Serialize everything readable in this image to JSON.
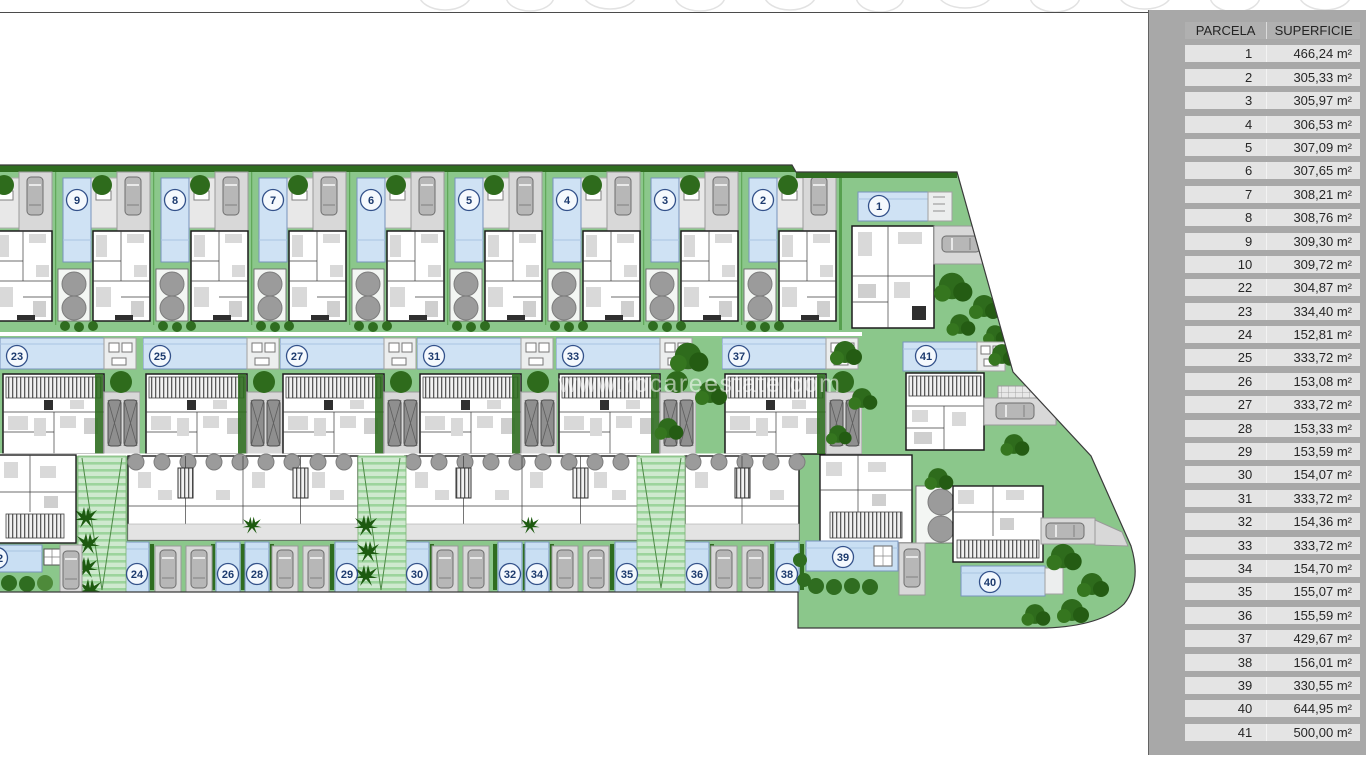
{
  "watermark": "www.rocareestate.com",
  "colors": {
    "panel": "#a8a8a8",
    "table_row": "#e4e4e4",
    "table_header": "#b0b0b0",
    "lawn": "#8bc78b",
    "pool": "#cfe2f4",
    "tree": "#2e6b1c",
    "driveway": "#d8d8d8",
    "badge_ring": "#33518a"
  },
  "table": {
    "headers": [
      "PARCELA",
      "SUPERFICIE"
    ],
    "rows": [
      [
        "1",
        "466,24 m²"
      ],
      [
        "2",
        "305,33 m²"
      ],
      [
        "3",
        "305,97 m²"
      ],
      [
        "4",
        "306,53 m²"
      ],
      [
        "5",
        "307,09 m²"
      ],
      [
        "6",
        "307,65 m²"
      ],
      [
        "7",
        "308,21 m²"
      ],
      [
        "8",
        "308,76 m²"
      ],
      [
        "9",
        "309,30 m²"
      ],
      [
        "10",
        "309,72 m²"
      ],
      [
        "22",
        "304,87 m²"
      ],
      [
        "23",
        "334,40 m²"
      ],
      [
        "24",
        "152,81 m²"
      ],
      [
        "25",
        "333,72 m²"
      ],
      [
        "26",
        "153,08 m²"
      ],
      [
        "27",
        "333,72 m²"
      ],
      [
        "28",
        "153,33 m²"
      ],
      [
        "29",
        "153,59 m²"
      ],
      [
        "30",
        "154,07 m²"
      ],
      [
        "31",
        "333,72 m²"
      ],
      [
        "32",
        "154,36 m²"
      ],
      [
        "33",
        "333,72 m²"
      ],
      [
        "34",
        "154,70 m²"
      ],
      [
        "35",
        "155,07 m²"
      ],
      [
        "36",
        "155,59 m²"
      ],
      [
        "37",
        "429,67 m²"
      ],
      [
        "38",
        "156,01 m²"
      ],
      [
        "39",
        "330,55 m²"
      ],
      [
        "40",
        "644,95 m²"
      ],
      [
        "41",
        "500,00 m²"
      ]
    ]
  },
  "plan": {
    "badges": [
      {
        "n": "9",
        "x": 77,
        "y": 200
      },
      {
        "n": "8",
        "x": 175,
        "y": 200
      },
      {
        "n": "7",
        "x": 273,
        "y": 200
      },
      {
        "n": "6",
        "x": 371,
        "y": 200
      },
      {
        "n": "5",
        "x": 469,
        "y": 200
      },
      {
        "n": "4",
        "x": 567,
        "y": 200
      },
      {
        "n": "3",
        "x": 665,
        "y": 200
      },
      {
        "n": "2",
        "x": 763,
        "y": 200
      },
      {
        "n": "1",
        "x": 879,
        "y": 206
      },
      {
        "n": "23",
        "x": 17,
        "y": 356
      },
      {
        "n": "25",
        "x": 160,
        "y": 356
      },
      {
        "n": "27",
        "x": 297,
        "y": 356
      },
      {
        "n": "31",
        "x": 434,
        "y": 356
      },
      {
        "n": "33",
        "x": 573,
        "y": 356
      },
      {
        "n": "37",
        "x": 739,
        "y": 356
      },
      {
        "n": "41",
        "x": 926,
        "y": 356
      },
      {
        "n": "22",
        "x": -3,
        "y": 558
      },
      {
        "n": "24",
        "x": 137,
        "y": 574
      },
      {
        "n": "26",
        "x": 228,
        "y": 574
      },
      {
        "n": "28",
        "x": 257,
        "y": 574
      },
      {
        "n": "29",
        "x": 347,
        "y": 574
      },
      {
        "n": "30",
        "x": 417,
        "y": 574
      },
      {
        "n": "32",
        "x": 510,
        "y": 574
      },
      {
        "n": "34",
        "x": 537,
        "y": 574
      },
      {
        "n": "35",
        "x": 627,
        "y": 574
      },
      {
        "n": "36",
        "x": 697,
        "y": 574
      },
      {
        "n": "38",
        "x": 787,
        "y": 574
      },
      {
        "n": "39",
        "x": 843,
        "y": 557
      },
      {
        "n": "40",
        "x": 990,
        "y": 582
      }
    ]
  }
}
